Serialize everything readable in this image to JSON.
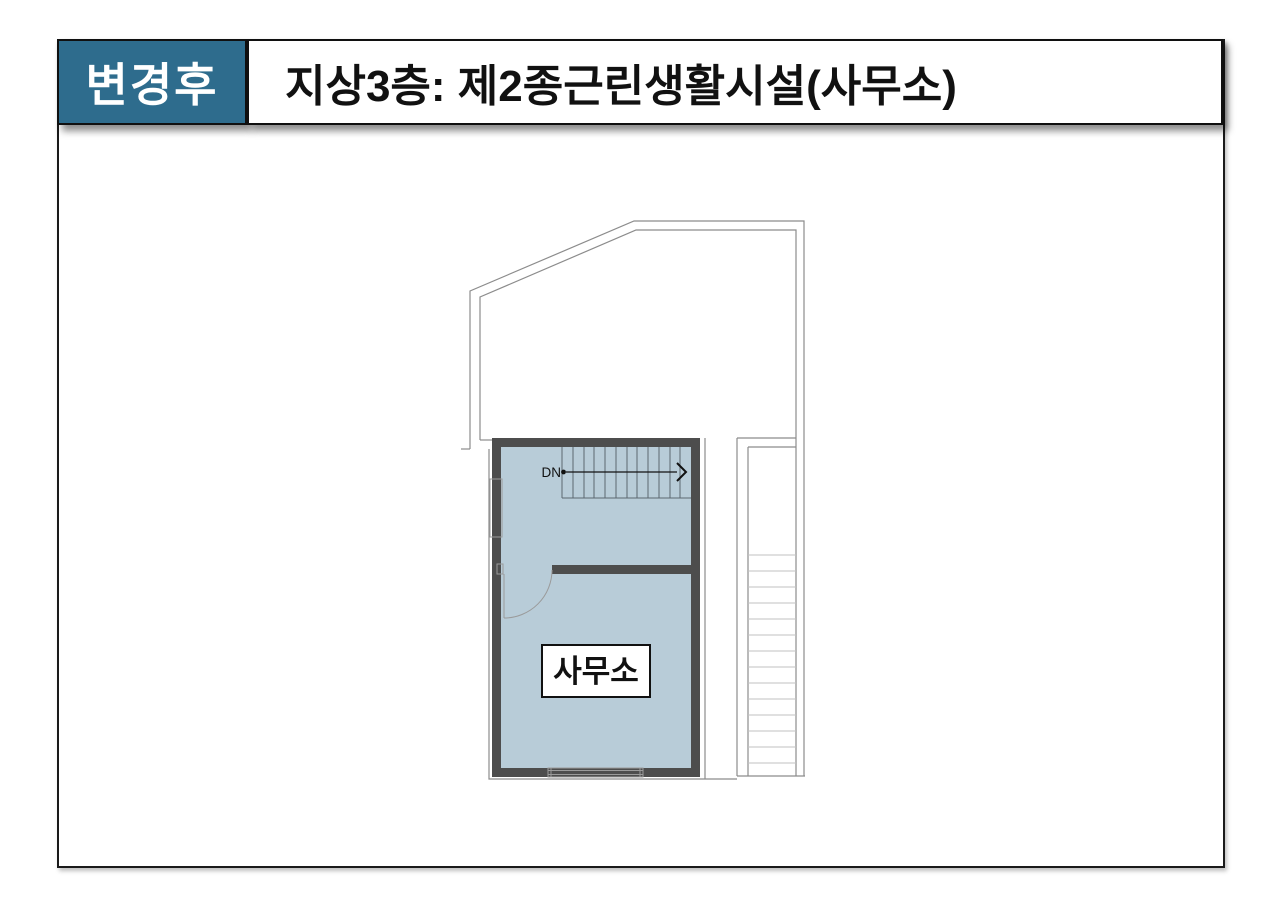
{
  "slide": {
    "badge_label": "변경후",
    "title": "지상3층: 제2종근린생활시설(사무소)"
  },
  "floor_plan": {
    "room_label": "사무소",
    "stair_direction_label": "DN"
  },
  "colors": {
    "badge_bg": "#2E6C8D",
    "badge_text": "#FFFFFF",
    "title_text": "#111111",
    "frame_border": "#1A1A1A",
    "wall": "#4D4D4D",
    "room_fill": "#B8CCD8",
    "outline_gray": "#8C8C8C",
    "tread_gray": "#C2C2C2"
  }
}
